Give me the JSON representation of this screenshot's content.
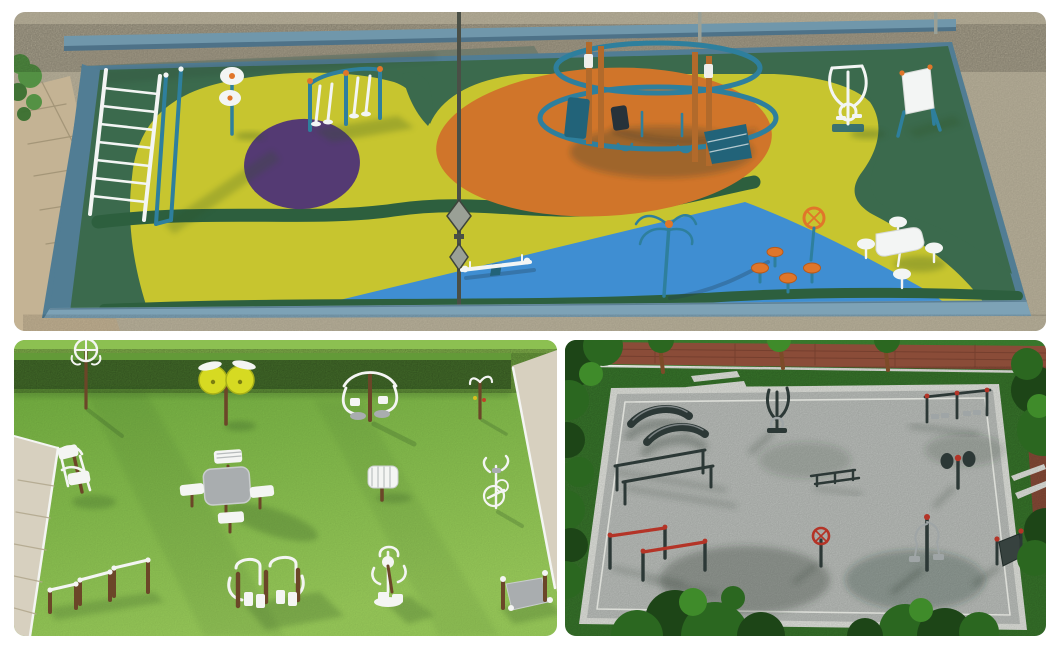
{
  "page": {
    "background": "#ffffff",
    "description": "Collage of three 3D renders of outdoor fitness park design concepts"
  },
  "palette": {
    "page_bg": "#ffffff",
    "top_sand": "#bdb59e",
    "top_paver": "#c4b394",
    "top_paver_line": "#9d8f72",
    "top_wall": "#aaa28d",
    "top_wall_inner": "#6e7a6c",
    "top_rail": "#7097ab",
    "top_rail_dark": "#4e7288",
    "top_field": "#3b6a4d",
    "top_stripe": "#2d5f3e",
    "top_yellow": "#c7c52f",
    "top_orange": "#d0752a",
    "top_purple": "#543a73",
    "top_blue": "#3f8ed2",
    "top_curb": "#517d94",
    "top_curb_light": "#7da2b6",
    "equip_teal": "#2e7f9d",
    "equip_teal_dark": "#226379",
    "equip_orange": "#e0762a",
    "equip_white": "#f3f5f4",
    "equip_wood": "#b26a2b",
    "lamp_grey": "#4a4f46",
    "lamp_metal": "#9aa096",
    "bush_green": "#4f9040",
    "bl_grass_top": "#6fae3e",
    "bl_grass_bottom": "#9ccf5c",
    "bl_hedge": "#4a772e",
    "bl_hedge_top": "#639a38",
    "bl_lawn_strip": "#8cc051",
    "bl_path": "#d7d0bf",
    "bl_path_line": "#b3a98f",
    "bl_white": "#f4f5f3",
    "bl_wood": "#6b4628",
    "bl_grey": "#a9adaf",
    "bl_disc_yellow": "#d6da22",
    "br_grass": "#3e8230",
    "br_grass_light": "#4f9c3c",
    "br_tree_dark": "#1d4517",
    "br_tree": "#2b6720",
    "br_tree_light": "#3f8b2a",
    "br_trunk": "#7c4b28",
    "br_brick": "#8a4c38",
    "br_brick_line": "#6d3a2b",
    "br_gravel": "#c2c6c2",
    "br_frame": "#e8eae4",
    "br_dark": "#2c3836",
    "br_red": "#b43427",
    "br_grey": "#9fa5a6",
    "shadow_green": "#2f5222",
    "shadow_cool": "#203a4f",
    "shadow_dark": "#28352a"
  },
  "panels": {
    "top": {
      "description": "Aerial 3D render of a multicoloured rubber-surfaced fitness playground enclosed by a concrete wall: dark green base with yellow organic island, orange oval, purple circle and blue wedge zones, teal exercise equipment, lamp post and picnic table",
      "zones": [
        "green-base",
        "yellow-island",
        "orange-oval",
        "purple-circle",
        "blue-wedge"
      ],
      "equipment": [
        "monkey-bar-ladder",
        "tai-chi-wheel-post",
        "double-air-walker",
        "circular-climbing-rig",
        "elliptical-trainer",
        "information-board",
        "street-lamp",
        "seesaw",
        "tai-chi-spinner",
        "steering-wheel-and-stools",
        "picnic-table-set"
      ]
    },
    "bottom_left": {
      "description": "3D render of a lawn fitness area beside paved walkways with white-and-timber outdoor gym equipment: spinner post, yellow tai-chi wheels, leg press stations, chess table with benches, push-up bars, stepper, massage roller, bike and slide board",
      "equipment": [
        "rotating-spinner-post",
        "yellow-tai-chi-wheels",
        "leg-press-station",
        "chess-table-with-benches",
        "triple-push-up-bars",
        "double-leg-press",
        "leg-lift-station",
        "handle-post",
        "massage-roller",
        "exercise-bike",
        "stepper",
        "slide-board"
      ]
    },
    "bottom_right": {
      "description": "Aerial 3D render of a gravel calisthenics court framed by a white kerb among dense trees: dark steel curved benches, parallel bars, red-grip pull-up bars, dip station row, flywheel and pull stations, incline board, brick path and zebra crossings",
      "equipment": [
        "curved-benches",
        "elliptical-trainer",
        "parallel-bars",
        "red-grip-pull-up-bars",
        "dip-station-row",
        "flywheel-station",
        "double-pull-station",
        "steering-wheel-post",
        "incline-board",
        "low-bar-rack"
      ]
    }
  }
}
